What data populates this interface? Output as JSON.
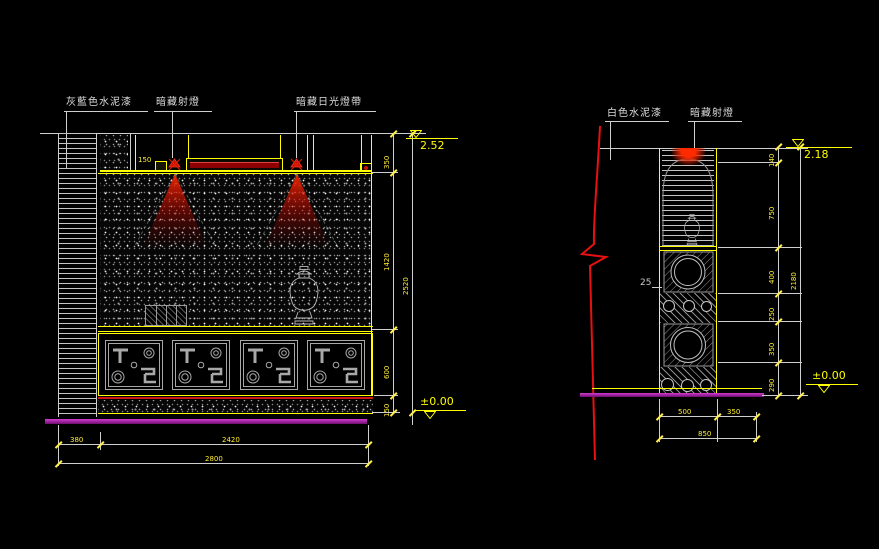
{
  "left": {
    "labels": {
      "paint": "灰藍色水泥漆",
      "spot": "暗藏射燈",
      "strip": "暗藏日光燈帶"
    },
    "cove": "150",
    "level_top": "2.52",
    "level_bottom": "±0.00",
    "v": [
      "350",
      "1420",
      "600",
      "150"
    ],
    "v_total": "2520",
    "h": [
      "380",
      "2420"
    ],
    "h_total": "2800"
  },
  "right": {
    "labels": {
      "paint": "白色水泥漆",
      "spot": "暗藏射燈"
    },
    "thickness": "25",
    "level_top": "2.18",
    "level_bottom": "±0.00",
    "v": [
      "140",
      "750",
      "400",
      "250",
      "350",
      "290"
    ],
    "v_total": "2180",
    "h": [
      "500",
      "350"
    ],
    "h_total": "850"
  },
  "colors": {
    "background": "#000000",
    "line_white": "#cfcfcf",
    "line_yellow": "#ffff00",
    "light_red": "#ff2a00",
    "tube_dark_red": "#8c0000",
    "floor_magenta": "#b126b1"
  }
}
